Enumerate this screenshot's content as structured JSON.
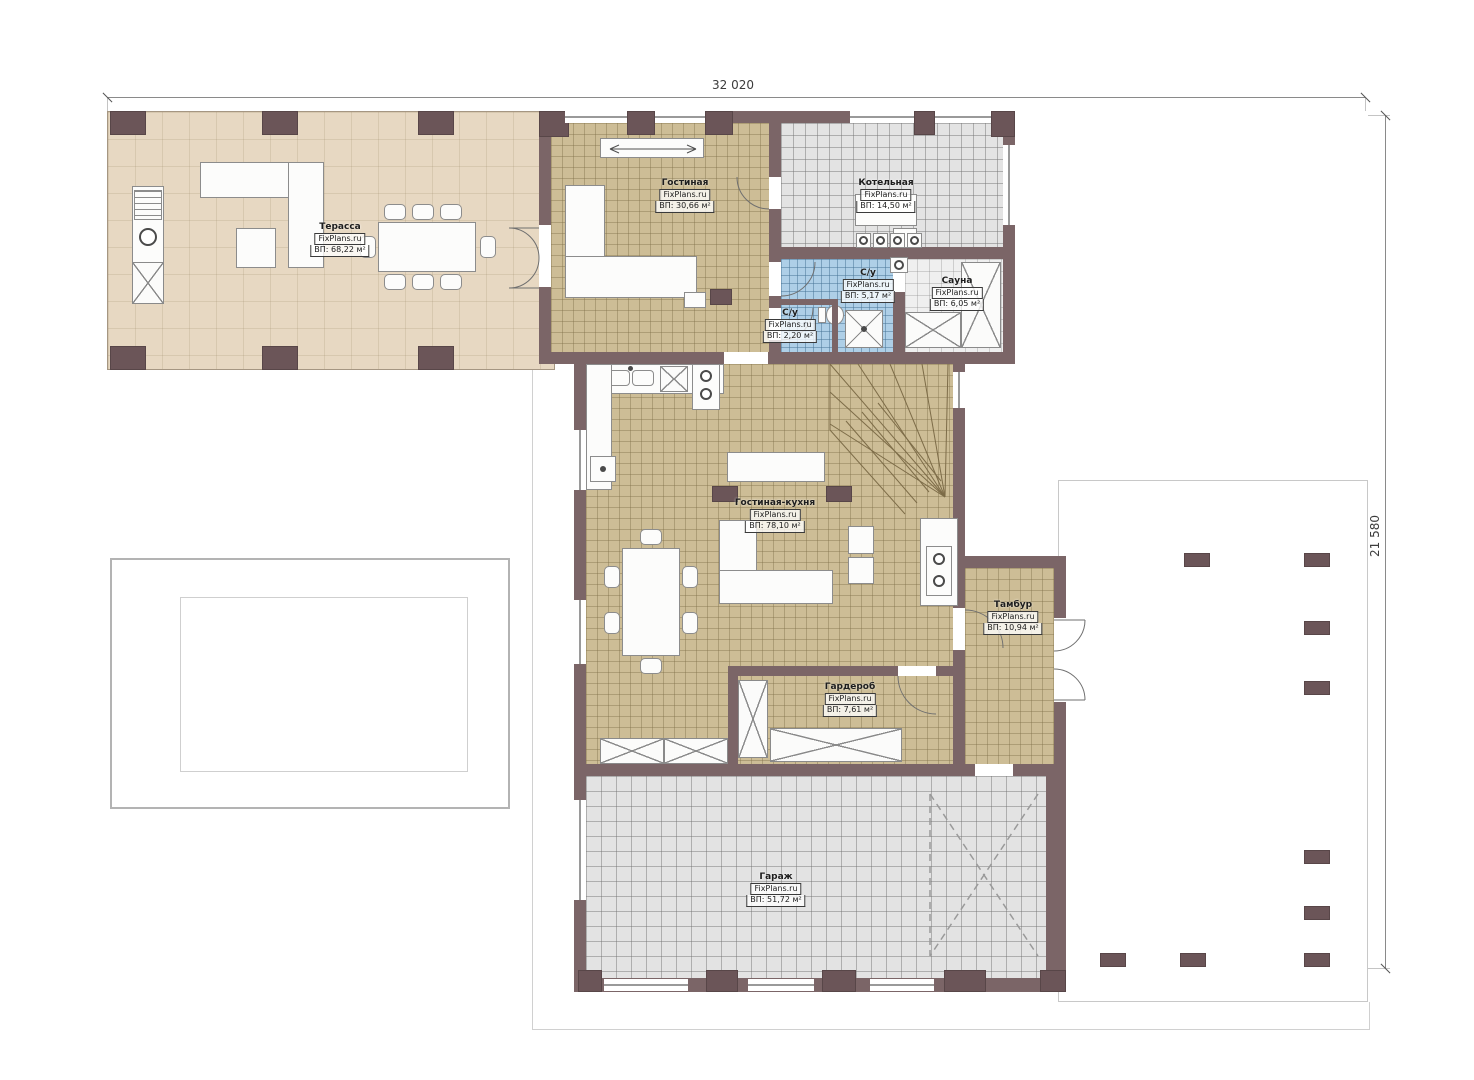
{
  "plan": {
    "watermark": "FixPlans.ru",
    "dimensions": {
      "width_label": "32 020",
      "height_label": "21 580"
    },
    "rooms": {
      "terrace": {
        "name": "Терасса",
        "area": "ВП: 68,22 м²"
      },
      "living": {
        "name": "Гостиная",
        "area": "ВП: 30,66 м²"
      },
      "boiler": {
        "name": "Котельная",
        "area": "ВП: 14,50 м²"
      },
      "bathroom": {
        "name": "С/у",
        "area": "ВП: 5,17 м²"
      },
      "sauna": {
        "name": "Сауна",
        "area": "ВП: 6,05 м²"
      },
      "wc": {
        "name": "С/у",
        "area": "ВП: 2,20 м²"
      },
      "kitchen_living": {
        "name": "Гостиная-кухня",
        "area": "ВП: 78,10 м²"
      },
      "vestibule": {
        "name": "Тамбур",
        "area": "ВП: 10,94 м²"
      },
      "wardrobe": {
        "name": "Гардероб",
        "area": "ВП: 7,61 м²"
      },
      "garage": {
        "name": "Гараж",
        "area": "ВП: 51,72 м²"
      }
    },
    "colors": {
      "wall": "#7b6567",
      "floor_tile_tan": "#cdbd96",
      "terrace_floor": "#e7d8c2",
      "garage_floor": "#e3e3e3",
      "wet_room_floor": "#aecfe7"
    }
  }
}
